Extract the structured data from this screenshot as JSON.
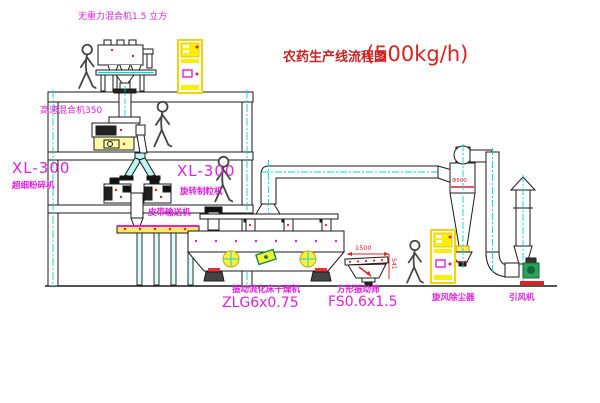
{
  "title": {
    "name": "农药生产线流程图",
    "capacity": "(500kg/h)"
  },
  "labels": {
    "gravity_mixer": "无重力混合机1.5 立方",
    "high_speed_mixer": "高速混合机350",
    "xl300_left": "XL-300",
    "pulverizer": "超细粉碎机",
    "xl300_right": "XL-300",
    "granulator": "旋转制粒机",
    "belt_conveyor": "皮带输送机",
    "dryer_name": "振动流化床干燥机",
    "dryer_model": "ZLG6x0.75",
    "sieve_name": "方形振动筛",
    "sieve_model": "FS0.6x1.5",
    "cyclone": "旋风除尘器",
    "fan": "引风机"
  },
  "dimensions": {
    "sieve_width": "1500",
    "sieve_height": "541",
    "cyclone_dia": "Φ500"
  },
  "colors": {
    "label_magenta": "#e020e0",
    "title_red": "#e02020",
    "centerline_cyan": "#00d8d8",
    "cabinet_yellow": "#ffee00",
    "line_black": "#1a1a1a"
  }
}
